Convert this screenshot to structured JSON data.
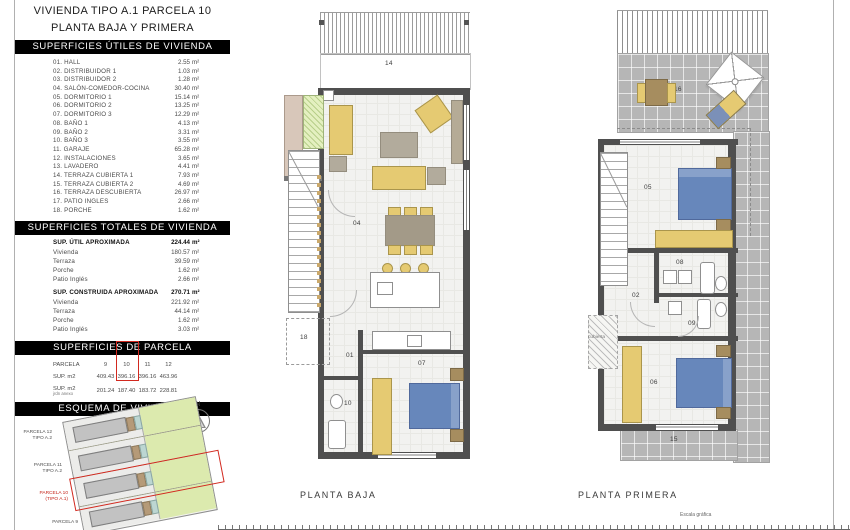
{
  "title": {
    "line1": "VIVIENDA TIPO A.1 PARCELA 10",
    "line2": "PLANTA BAJA Y PRIMERA"
  },
  "sections": {
    "utiles": "SUPERFICIES ÚTILES DE VIVIENDA",
    "totales": "SUPERFICIES TOTALES DE VIVIENDA",
    "parcela": "SUPERFICIES DE PARCELA",
    "esquema": "ESQUEMA DE VIVIENDAS"
  },
  "area_unit": "m²",
  "rooms": [
    {
      "num": "01.",
      "name": "HALL",
      "area": "2.55"
    },
    {
      "num": "02.",
      "name": "DISTRIBUIDOR 1",
      "area": "1.03"
    },
    {
      "num": "03.",
      "name": "DISTRIBUIDOR 2",
      "area": "1.28"
    },
    {
      "num": "04.",
      "name": "SALÓN-COMEDOR-COCINA",
      "area": "30.40"
    },
    {
      "num": "05.",
      "name": "DORMITORIO 1",
      "area": "15.14"
    },
    {
      "num": "06.",
      "name": "DORMITORIO 2",
      "area": "13.25"
    },
    {
      "num": "07.",
      "name": "DORMITORIO 3",
      "area": "12.29"
    },
    {
      "num": "08.",
      "name": "BAÑO 1",
      "area": "4.13"
    },
    {
      "num": "09.",
      "name": "BAÑO 2",
      "area": "3.31"
    },
    {
      "num": "10.",
      "name": "BAÑO 3",
      "area": "3.55"
    },
    {
      "num": "11.",
      "name": "GARAJE",
      "area": "65.28"
    },
    {
      "num": "12.",
      "name": "INSTALACIONES",
      "area": "3.65"
    },
    {
      "num": "13.",
      "name": "LAVADERO",
      "area": "4.41"
    },
    {
      "num": "14.",
      "name": "TERRAZA CUBIERTA 1",
      "area": "7.93"
    },
    {
      "num": "15.",
      "name": "TERRAZA CUBIERTA 2",
      "area": "4.69"
    },
    {
      "num": "16.",
      "name": "TERRAZA DESCUBIERTA",
      "area": "26.97"
    },
    {
      "num": "17.",
      "name": "PATIO INGLES",
      "area": "2.66"
    },
    {
      "num": "18.",
      "name": "PORCHE",
      "area": "1.62"
    }
  ],
  "totals": {
    "blocks": [
      {
        "header": "SUP. ÚTIL APROXIMADA",
        "value": "224.44",
        "items": [
          {
            "label": "Vivienda",
            "value": "180.57"
          },
          {
            "label": "Terraza",
            "value": "39.59"
          },
          {
            "label": "Porche",
            "value": "1.62"
          },
          {
            "label": "Patio Inglés",
            "value": "2.66"
          }
        ]
      },
      {
        "header": "SUP. CONSTRUIDA APROXIMADA",
        "value": "270.71",
        "items": [
          {
            "label": "Vivienda",
            "value": "221.92"
          },
          {
            "label": "Terraza",
            "value": "44.14"
          },
          {
            "label": "Porche",
            "value": "1.62"
          },
          {
            "label": "Patio Inglés",
            "value": "3.03"
          }
        ]
      }
    ]
  },
  "parcela_table": {
    "row_header": "PARCELA",
    "cols": [
      "9",
      "10",
      "11",
      "12"
    ],
    "sup_label": "SUP. m2",
    "sup_values": [
      "409.43",
      "396.16",
      "396.16",
      "463.96"
    ],
    "jardin_label": "SUP. m2",
    "jardin_sublabel": "jrdn anexo",
    "jardin_values": [
      "201.24",
      "187.40",
      "183.72",
      "228.81"
    ],
    "highlighted_col": "10"
  },
  "esquema": {
    "north_label": "N",
    "parcels": [
      {
        "label1": "PARCELA 12",
        "label2": "TIPO A.2"
      },
      {
        "label1": "PARCELA 11",
        "label2": "TIPO A.2"
      },
      {
        "label1": "PARCELA 10",
        "label2": "(TIPO A.1)"
      },
      {
        "label1": "PARCELA 9",
        "label2": ""
      }
    ]
  },
  "plans": {
    "baja": {
      "caption": "PLANTA BAJA",
      "labels": {
        "terraza_cubierta": "14",
        "salon": "04",
        "hall": "01",
        "bano3": "10",
        "dormitorio3": "07",
        "porche": "18"
      }
    },
    "primera": {
      "caption": "PLANTA PRIMERA",
      "labels": {
        "terraza_descubierta": "16",
        "dormitorio1": "05",
        "distribuidor1": "02",
        "bano1": "08",
        "bano2": "09",
        "dormitorio2": "06",
        "terraza_cubierta2": "15",
        "cubierta": "cubierta"
      }
    }
  },
  "footer": {
    "scale_label": "Escala gráfica"
  },
  "colors": {
    "accent_red": "#d2291f",
    "furniture_yellow": "#e5ca72",
    "bed_blue": "#6787bb",
    "wall_gray": "#4f4f4f",
    "garden_green": "#dceaae"
  }
}
